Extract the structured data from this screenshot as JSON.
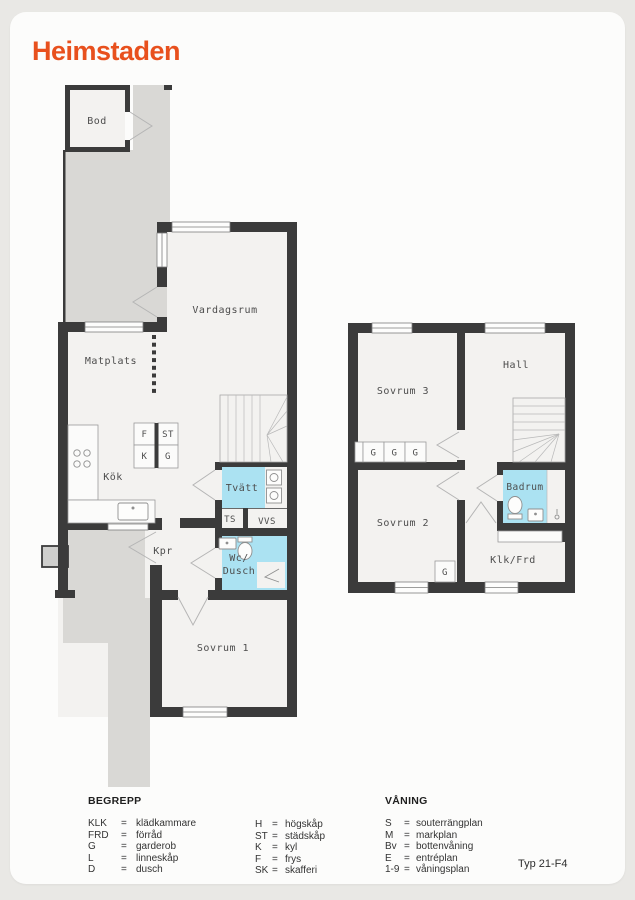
{
  "brand": "Heimstaden",
  "type_label": "Typ 21-F4",
  "colors": {
    "brand_orange": "#e8501d",
    "wall": "#3b3b3b",
    "floor": "#f3f2f0",
    "outside_gray": "#d9d8d5",
    "wet_room_blue": "#abe2f2"
  },
  "plans": {
    "ground": {
      "rooms": {
        "bod": "Bod",
        "vardagsrum": "Vardagsrum",
        "matplats": "Matplats",
        "kok": "Kök",
        "tvatt": "Tvätt",
        "ts": "TS",
        "vvs": "VVS",
        "kpr": "Kpr",
        "wc_line1": "Wc/",
        "wc_line2": "Dusch",
        "sovrum1": "Sovrum 1"
      },
      "cabinets": {
        "f": "F",
        "st": "ST",
        "k": "K",
        "g": "G"
      }
    },
    "upper": {
      "rooms": {
        "sovrum3": "Sovrum 3",
        "hall": "Hall",
        "sovrum2": "Sovrum 2",
        "badrum": "Badrum",
        "klk_frd": "Klk/Frd"
      },
      "wardrobe": "G"
    }
  },
  "legend": {
    "eq": "=",
    "begrepp": {
      "title": "BEGREPP",
      "col1": [
        {
          "abbr": "KLK",
          "def": "klädkammare"
        },
        {
          "abbr": "FRD",
          "def": "förråd"
        },
        {
          "abbr": "G",
          "def": "garderob"
        },
        {
          "abbr": "L",
          "def": "linneskåp"
        },
        {
          "abbr": "D",
          "def": "dusch"
        }
      ],
      "col2": [
        {
          "abbr": "H",
          "def": "högskåp"
        },
        {
          "abbr": "ST",
          "def": "städskåp"
        },
        {
          "abbr": "K",
          "def": "kyl"
        },
        {
          "abbr": "F",
          "def": "frys"
        },
        {
          "abbr": "SK",
          "def": "skafferi"
        }
      ]
    },
    "vaning": {
      "title": "VÅNING",
      "items": [
        {
          "abbr": "S",
          "def": "souterrängplan"
        },
        {
          "abbr": "M",
          "def": "markplan"
        },
        {
          "abbr": "Bv",
          "def": "bottenvåning"
        },
        {
          "abbr": "E",
          "def": "entréplan"
        },
        {
          "abbr": "1-9",
          "def": "våningsplan"
        }
      ]
    }
  }
}
